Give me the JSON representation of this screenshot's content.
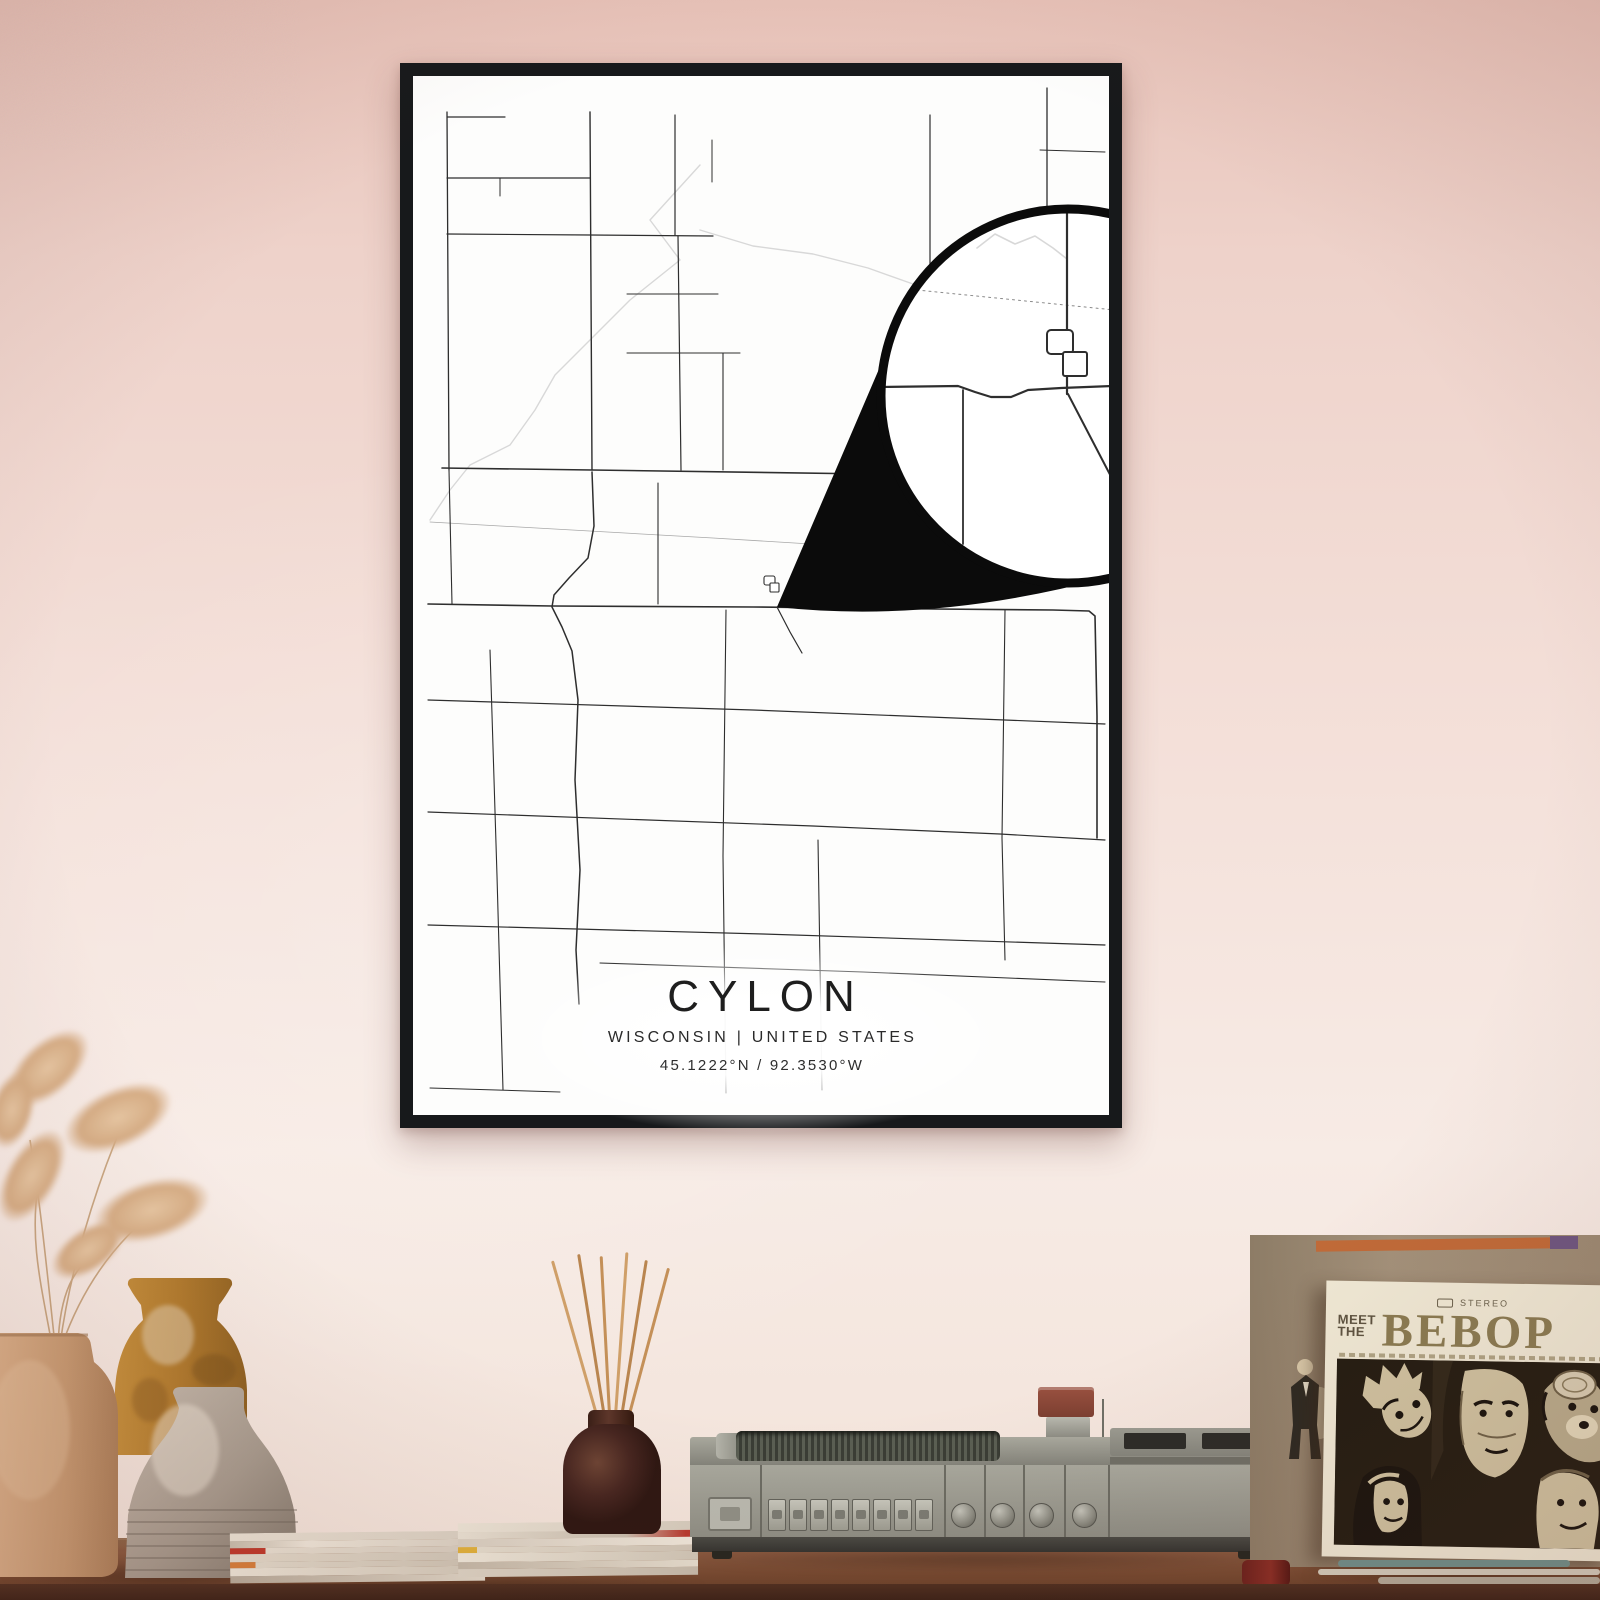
{
  "scene": {
    "wall_top_color": "#e7c2b8",
    "wall_mid_color": "#f3ded7",
    "wall_bottom_color": "#f2e2d8",
    "table_top_color": "#8a5a40",
    "table_front_color": "#4f2f20"
  },
  "poster": {
    "title": "CYLON",
    "subtitle": "WISCONSIN | UNITED STATES",
    "coordinates": "45.1222°N / 92.3530°W",
    "frame_color": "#17191b",
    "paper_color": "#fdfdfc",
    "map": {
      "road_color": "#2e2e2e",
      "faint_color": "#a8a8a8",
      "river_color": "#d8d8d8",
      "roads": [
        {
          "w": 1.3,
          "p": [
            [
              34,
              36
            ],
            [
              36,
              394
            ]
          ]
        },
        {
          "w": 1.1,
          "p": [
            [
              36,
              394
            ],
            [
              39,
              528
            ]
          ]
        },
        {
          "w": 1.2,
          "p": [
            [
              34,
              41
            ],
            [
              92,
              41
            ]
          ]
        },
        {
          "w": 1.2,
          "p": [
            [
              34,
              102
            ],
            [
              177,
              102
            ]
          ]
        },
        {
          "w": 1.0,
          "p": [
            [
              87,
              102
            ],
            [
              87,
              120
            ]
          ]
        },
        {
          "w": 1.2,
          "p": [
            [
              34,
              158
            ],
            [
              177,
              159
            ],
            [
              300,
              160
            ]
          ]
        },
        {
          "w": 1.2,
          "p": [
            [
              262,
              39
            ],
            [
              262,
              159
            ]
          ]
        },
        {
          "w": 1.0,
          "p": [
            [
              299,
              64
            ],
            [
              299,
              106
            ]
          ]
        },
        {
          "w": 1.2,
          "p": [
            [
              265,
              160
            ],
            [
              268,
              394
            ]
          ]
        },
        {
          "w": 1.1,
          "p": [
            [
              214,
              218
            ],
            [
              305,
              218
            ]
          ]
        },
        {
          "w": 1.1,
          "p": [
            [
              214,
              277
            ],
            [
              327,
              277
            ]
          ]
        },
        {
          "w": 1.1,
          "p": [
            [
              310,
              277
            ],
            [
              310,
              394
            ]
          ]
        },
        {
          "w": 1.4,
          "p": [
            [
              177,
              36
            ],
            [
              179,
              394
            ]
          ]
        },
        {
          "w": 1.6,
          "p": [
            [
              29,
              392
            ],
            [
              179,
              394
            ],
            [
              457,
              398
            ],
            [
              560,
              400
            ]
          ]
        },
        {
          "w": 1.6,
          "p": [
            [
              560,
              400
            ],
            [
              692,
              402
            ]
          ]
        },
        {
          "w": 1.5,
          "p": [
            [
              179,
              396
            ],
            [
              181,
              450
            ],
            [
              175,
              482
            ],
            [
              156,
              502
            ],
            [
              141,
              519
            ],
            [
              139,
              531
            ],
            [
              149,
              551
            ],
            [
              159,
              575
            ],
            [
              165,
              624
            ],
            [
              162,
              704
            ],
            [
              167,
              794
            ],
            [
              163,
              874
            ],
            [
              166,
              928
            ]
          ]
        },
        {
          "w": 1.6,
          "p": [
            [
              15,
              528
            ],
            [
              139,
              530
            ],
            [
              340,
              531
            ],
            [
              520,
              533
            ],
            [
              640,
              534
            ],
            [
              676,
              535
            ],
            [
              682,
              540
            ],
            [
              684,
              640
            ],
            [
              684,
              762
            ]
          ]
        },
        {
          "w": 1.2,
          "p": [
            [
              364,
              531
            ],
            [
              377,
              556
            ],
            [
              389,
              577
            ]
          ]
        },
        {
          "w": 1.1,
          "p": [
            [
              245,
              407
            ],
            [
              245,
              528
            ]
          ]
        },
        {
          "w": 1.1,
          "p": [
            [
              440,
              404
            ],
            [
              440,
              530
            ]
          ]
        },
        {
          "w": 1.2,
          "p": [
            [
              517,
              39
            ],
            [
              517,
              196
            ]
          ]
        },
        {
          "w": 1.3,
          "p": [
            [
              634,
              12
            ],
            [
              634,
              136
            ]
          ]
        },
        {
          "w": 1.0,
          "p": [
            [
              627,
              74
            ],
            [
              692,
              76
            ]
          ]
        },
        {
          "w": 1.1,
          "p": [
            [
              77,
              574
            ],
            [
              84,
              800
            ],
            [
              90,
              1014
            ]
          ]
        },
        {
          "w": 1.1,
          "p": [
            [
              313,
              534
            ],
            [
              310,
              780
            ],
            [
              313,
              1017
            ]
          ]
        },
        {
          "w": 1.1,
          "p": [
            [
              405,
              764
            ],
            [
              409,
              1014
            ]
          ]
        },
        {
          "w": 1.1,
          "p": [
            [
              592,
              534
            ],
            [
              589,
              762
            ],
            [
              592,
              884
            ]
          ]
        },
        {
          "w": 1.2,
          "p": [
            [
              15,
              624
            ],
            [
              340,
              634
            ],
            [
              692,
              648
            ]
          ]
        },
        {
          "w": 1.2,
          "p": [
            [
              15,
              736
            ],
            [
              400,
              750
            ],
            [
              587,
              758
            ],
            [
              692,
              764
            ]
          ]
        },
        {
          "w": 1.2,
          "p": [
            [
              15,
              849
            ],
            [
              350,
              858
            ],
            [
              692,
              869
            ]
          ]
        },
        {
          "w": 1.1,
          "p": [
            [
              187,
              887
            ],
            [
              450,
              896
            ],
            [
              692,
              906
            ]
          ]
        },
        {
          "w": 1.0,
          "p": [
            [
              17,
              1012
            ],
            [
              147,
              1016
            ]
          ]
        }
      ],
      "faint_lines": [
        {
          "w": 0.8,
          "p": [
            [
              17,
              446
            ],
            [
              300,
              462
            ],
            [
              560,
              478
            ]
          ]
        }
      ],
      "rivers": [
        {
          "p": [
            [
              287,
              89
            ],
            [
              237,
              144
            ],
            [
              267,
              184
            ],
            [
              217,
              224
            ],
            [
              177,
              264
            ],
            [
              142,
              299
            ],
            [
              122,
              334
            ],
            [
              97,
              369
            ],
            [
              57,
              389
            ],
            [
              37,
              414
            ],
            [
              17,
              444
            ]
          ]
        },
        {
          "p": [
            [
              287,
              154
            ],
            [
              340,
              170
            ],
            [
              400,
              178
            ],
            [
              455,
              192
            ],
            [
              500,
              208
            ]
          ]
        }
      ],
      "town_blocks": [
        {
          "x": 351,
          "y": 500,
          "w": 11,
          "h": 9,
          "r": 2
        },
        {
          "x": 357,
          "y": 507,
          "w": 9,
          "h": 9,
          "r": 1
        }
      ],
      "cone_path": "M364,531 L502,209 A187,187 0 0 0 692,502 Q520,548 364,531 Z",
      "magnifier": {
        "cx": 655,
        "cy": 320,
        "r": 187,
        "ring_w": 9,
        "ring_color": "#0b0b0b",
        "roads": [
          {
            "w": 2.2,
            "p": [
              [
                654,
                129
              ],
              [
                654,
                318
              ]
            ]
          },
          {
            "w": 2.2,
            "p": [
              [
                468,
                311
              ],
              [
                545,
                310
              ],
              [
                562,
                316
              ],
              [
                578,
                321
              ],
              [
                598,
                321
              ],
              [
                615,
                314
              ],
              [
                648,
                312
              ],
              [
                700,
                310
              ],
              [
                838,
                308
              ]
            ]
          },
          {
            "w": 2.0,
            "p": [
              [
                655,
                318
              ],
              [
                680,
                366
              ],
              [
                704,
                412
              ]
            ]
          },
          {
            "w": 1.8,
            "p": [
              [
                550,
                314
              ],
              [
                550,
                468
              ]
            ]
          },
          {
            "w": 1.8,
            "p": [
              [
                824,
                317
              ],
              [
                824,
                470
              ]
            ]
          }
        ],
        "dashed": [
          {
            "w": 1.0,
            "p": [
              [
                504,
                214
              ],
              [
                830,
                247
              ]
            ]
          }
        ],
        "rivers": [
          {
            "p": [
              [
                564,
                172
              ],
              [
                582,
                158
              ],
              [
                602,
                168
              ],
              [
                622,
                160
              ],
              [
                640,
                172
              ],
              [
                654,
                183
              ]
            ]
          }
        ],
        "blocks": [
          {
            "x": 634,
            "y": 254,
            "w": 26,
            "h": 24,
            "r": 4
          },
          {
            "x": 650,
            "y": 276,
            "w": 24,
            "h": 24,
            "r": 2
          }
        ]
      }
    }
  },
  "album": {
    "stereo_label": "STEREO",
    "title_line1": "MEET",
    "title_line2": "THE",
    "title_main": "BEBOP",
    "header_color": "#efe8d4",
    "title_color": "#8a7b52",
    "art_bg_color": "#241d12"
  },
  "decor": {
    "vase_left_color": "#cfa17b",
    "vase_amber_color": "#b97c2e",
    "vase_gray_color": "#a99c8f",
    "diffuser_bottle_color": "#44241a",
    "reed_color": "#c99a66",
    "player_body_color": "#97978d",
    "pampas_color": "#d9b48f"
  }
}
